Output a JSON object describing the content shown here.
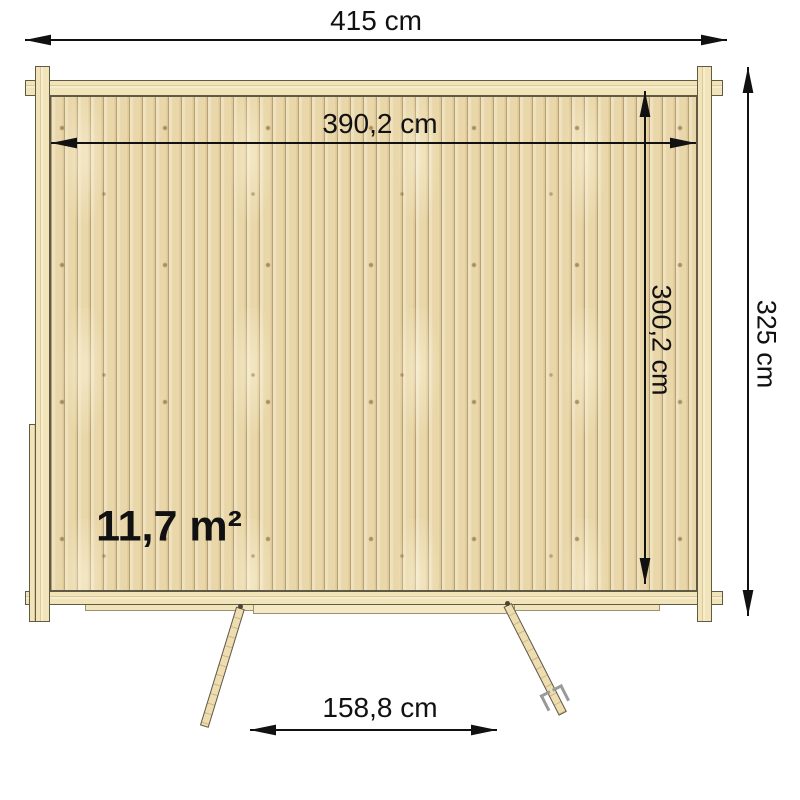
{
  "figure": {
    "kind": "log-cabin-floor-plan-top-view",
    "area_label": "11,7 m²",
    "dimensions": {
      "outer_width": "415 cm",
      "inner_width": "390,2 cm",
      "inner_depth": "300,2 cm",
      "outer_depth": "325 cm",
      "door_opening_width": "158,8 cm"
    },
    "colors": {
      "background": "#ffffff",
      "wood_wall": "#f2e4b9",
      "wood_floor": "#e9d7a9",
      "wood_seam": "#b89d66",
      "wood_knot": "#745024",
      "outline": "#5f5946",
      "dimension_ink": "#111111",
      "handle_gray": "#9a9a9a"
    }
  }
}
